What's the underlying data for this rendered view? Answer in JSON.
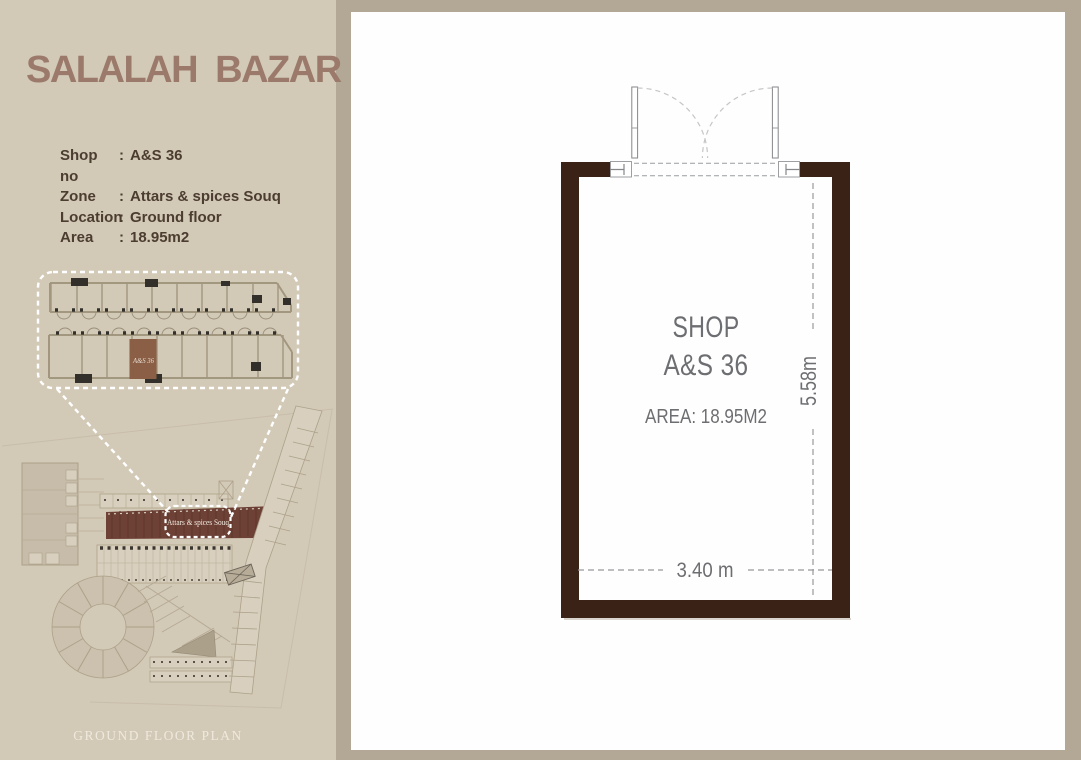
{
  "sidebar": {
    "title": "SALALAH  BAZAR",
    "colon": ":",
    "info": [
      {
        "label": "Shop no",
        "value": "A&S 36"
      },
      {
        "label": "Zone",
        "value": "Attars & spices Souq"
      },
      {
        "label": "Location",
        "value": "Ground floor"
      },
      {
        "label": "Area",
        "value": "18.95m2"
      }
    ],
    "inset": {
      "shop_label": "A&S 36"
    },
    "site": {
      "souq_label": "Attars & spices Souq"
    },
    "caption": "GROUND FLOOR PLAN"
  },
  "plan": {
    "title_line1": "SHOP",
    "title_line2": "A&S 36",
    "area": "AREA: 18.95M2",
    "dim_width": "3.40 m",
    "dim_height": "5.58m"
  },
  "colors": {
    "sidebar_bg": "#d3c9b7",
    "frame_bg": "#b2a895",
    "panel_bg": "#fefefe",
    "brand_text": "#9b7a6b",
    "info_text": "#4b3d30",
    "wall": "#3a2316",
    "plan_text": "#6d6e71",
    "souq_highlight": "#6e4136",
    "shop_highlight": "#8a5f46"
  }
}
